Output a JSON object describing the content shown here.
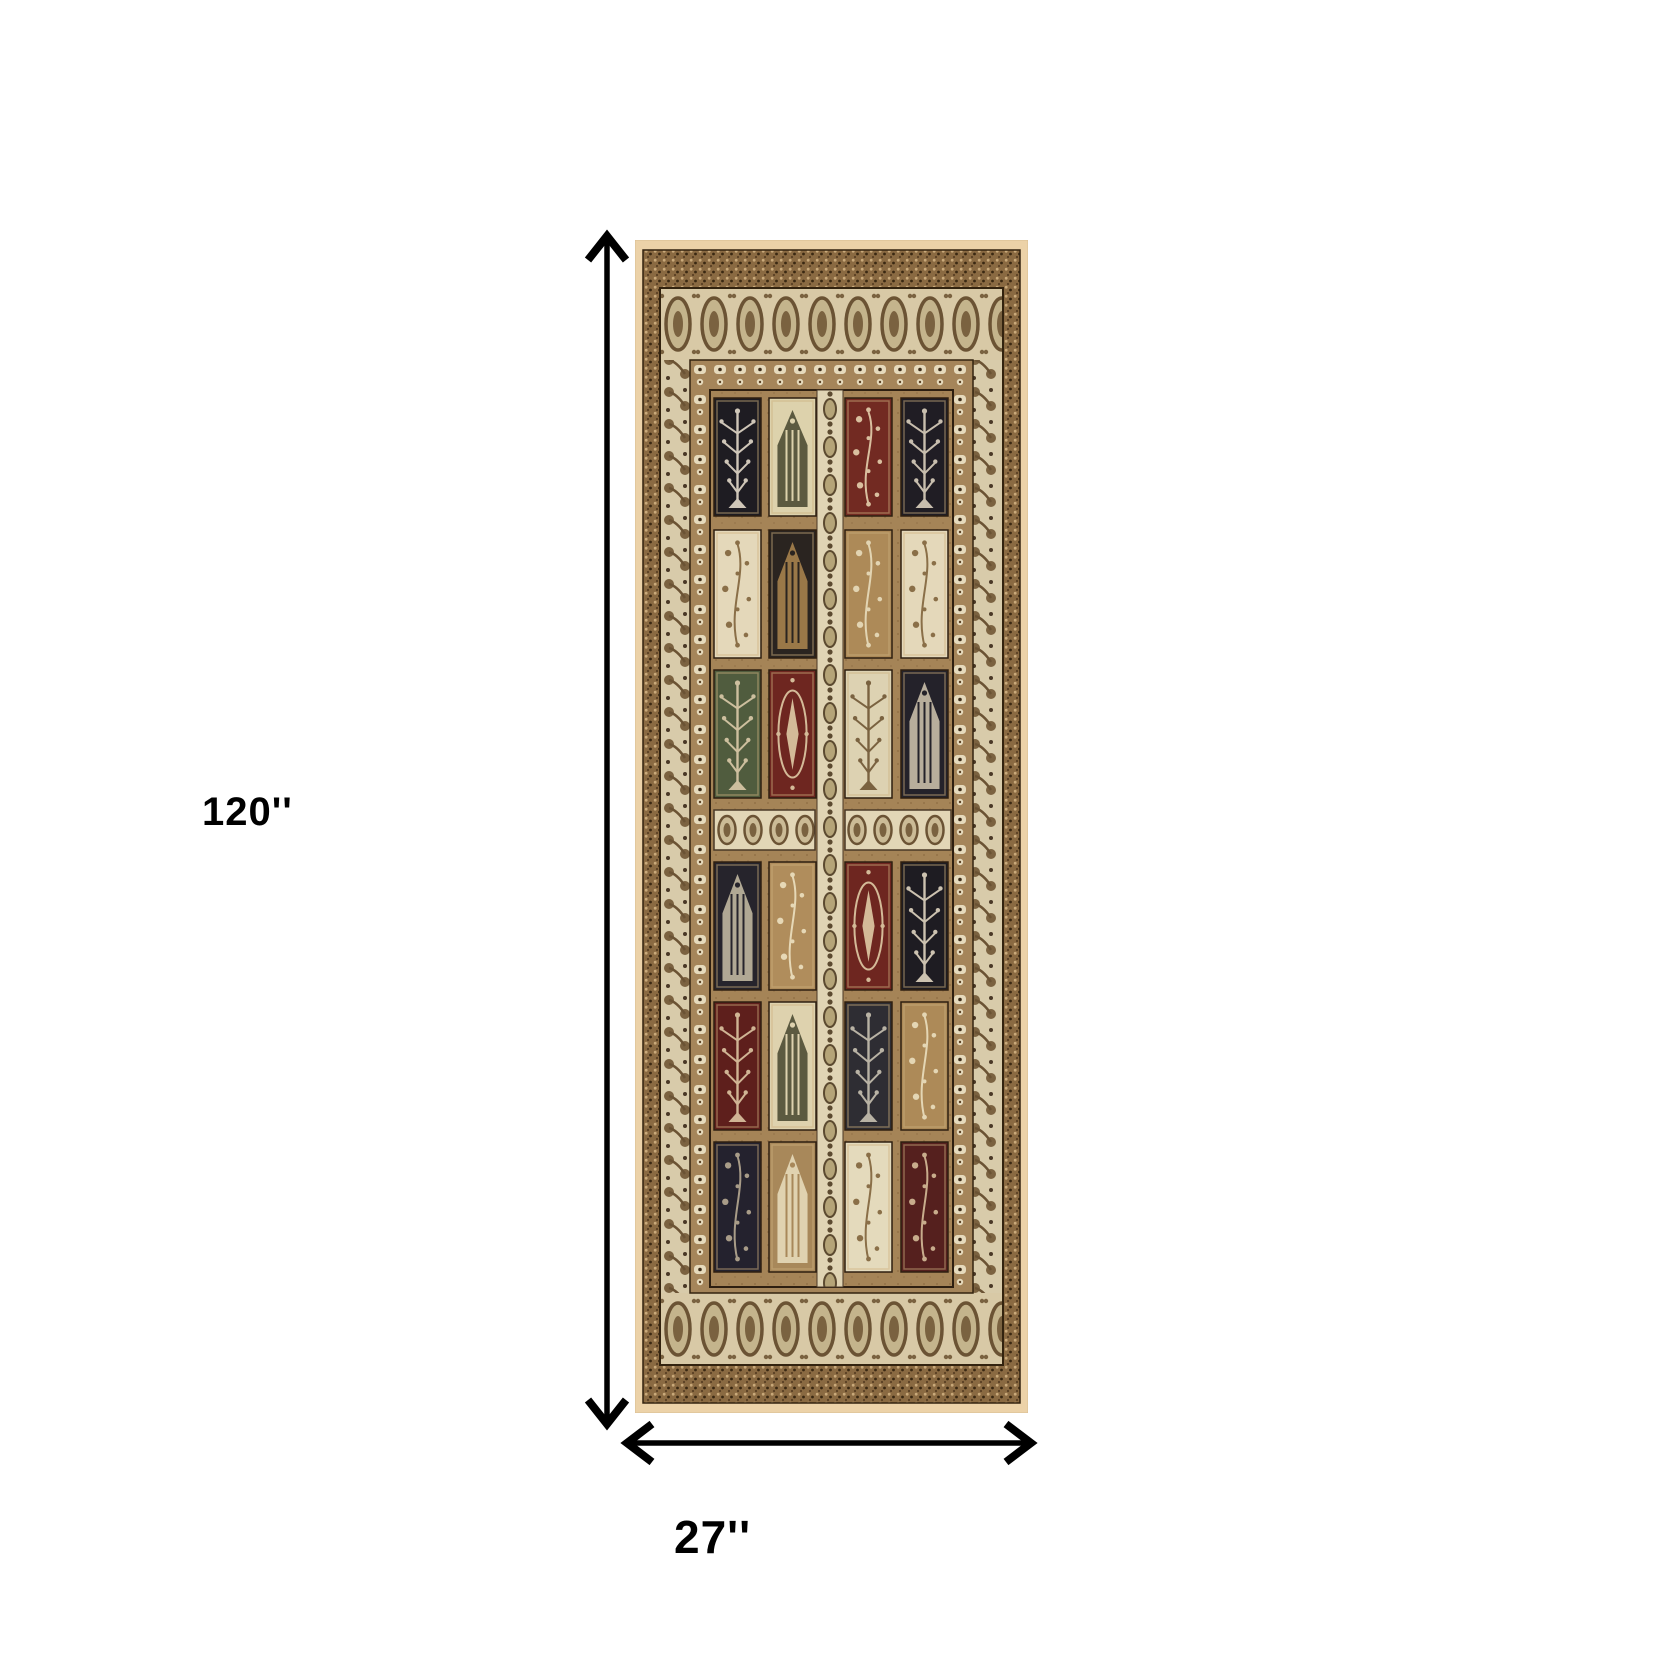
{
  "labels": {
    "height": "120''",
    "width": "27''"
  },
  "arrow_color": "#000000",
  "rug": {
    "palette": {
      "cream_edge": "#ecd2a8",
      "speckle_band": "#a8835a",
      "ivory_border": "#d8cbaa",
      "border_motif_brown": "#7b6240",
      "guard_band": "#a5855a",
      "field": "#a58457",
      "outline_dark": "#2e1f10"
    },
    "panel_grid": {
      "cols_x": [
        79,
        134,
        210,
        266
      ],
      "col_w": 47,
      "rows_y": [
        158,
        290,
        430,
        622,
        762,
        902
      ],
      "row_h": [
        118,
        128,
        128,
        128,
        128,
        130
      ]
    },
    "panels": [
      [
        {
          "bg": "#1e1c22",
          "fg": "#cfc6b8",
          "motif": "tree"
        },
        {
          "bg": "#ddd2ac",
          "fg": "#5c5a40",
          "motif": "arch"
        },
        {
          "bg": "#722a22",
          "fg": "#d9bf9f",
          "motif": "floral"
        },
        {
          "bg": "#201d24",
          "fg": "#c8beae",
          "motif": "tree"
        }
      ],
      [
        {
          "bg": "#e4d8ba",
          "fg": "#8a6f48",
          "motif": "floral"
        },
        {
          "bg": "#2a2420",
          "fg": "#9a7848",
          "motif": "arch"
        },
        {
          "bg": "#ad8a58",
          "fg": "#e2d4b2",
          "motif": "floral"
        },
        {
          "bg": "#e4d8ba",
          "fg": "#8a6f48",
          "motif": "floral"
        }
      ],
      [
        {
          "bg": "#505c3e",
          "fg": "#cdbf9e",
          "motif": "tree"
        },
        {
          "bg": "#6e2620",
          "fg": "#d4ba98",
          "motif": "medallion"
        },
        {
          "bg": "#ddd2b2",
          "fg": "#7a6240",
          "motif": "tree"
        },
        {
          "bg": "#24222a",
          "fg": "#b8ae9c",
          "motif": "arch"
        }
      ],
      [
        {
          "bg": "#26242c",
          "fg": "#b0a894",
          "motif": "arch"
        },
        {
          "bg": "#b08d5c",
          "fg": "#e6d8b6",
          "motif": "floral"
        },
        {
          "bg": "#6e2620",
          "fg": "#d4ba98",
          "motif": "medallion"
        },
        {
          "bg": "#1e1c22",
          "fg": "#ccc2b0",
          "motif": "tree"
        }
      ],
      [
        {
          "bg": "#5e1f1c",
          "fg": "#d0b494",
          "motif": "tree"
        },
        {
          "bg": "#ded2ae",
          "fg": "#5c5a40",
          "motif": "arch"
        },
        {
          "bg": "#2e2d33",
          "fg": "#b8b2a4",
          "motif": "tree"
        },
        {
          "bg": "#ad8a58",
          "fg": "#e4d6b4",
          "motif": "floral"
        }
      ],
      [
        {
          "bg": "#24222e",
          "fg": "#a89c88",
          "motif": "floral"
        },
        {
          "bg": "#a8885a",
          "fg": "#e0d2b0",
          "motif": "arch"
        },
        {
          "bg": "#e4dabc",
          "fg": "#8a6f48",
          "motif": "floral"
        },
        {
          "bg": "#55201e",
          "fg": "#c8ac8c",
          "motif": "floral"
        }
      ]
    ]
  }
}
